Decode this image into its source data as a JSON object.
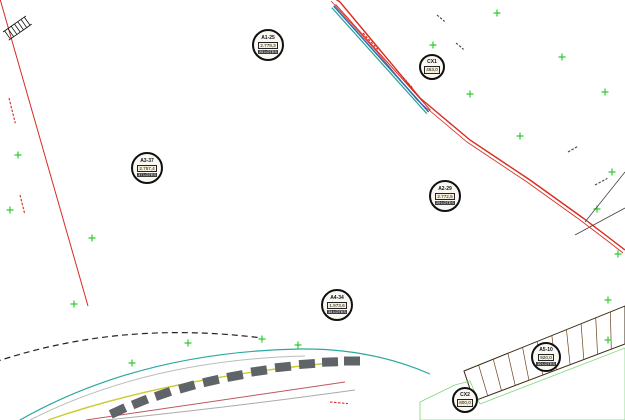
{
  "plan": {
    "size": {
      "w": 625,
      "h": 420
    },
    "colors": {
      "background": "#ffffff",
      "lot_fill": "#f2a45a",
      "lot_hatch": "#d4873a",
      "strip_line": "#4a3014",
      "division_line": "#6b421c",
      "block_outline": "#3a2a12",
      "road": "#44608c",
      "road_edge": "#d92b20",
      "boundary": "#d92b20",
      "avenue_stripe_blue": "#2a6db5",
      "avenue_stripe_teal": "#29a59b",
      "green_cross": "#2ecc2e",
      "green_line": "#3ecf3e",
      "green_area_fill": "#eef8ee",
      "green_area_line": "#7cd67c",
      "stall": "#5f6468",
      "arc_teal": "#2aa9a0",
      "arc_yellow": "#cccc2e",
      "arc_red": "#c05560",
      "dashed_boundary": "#222222",
      "badge_bg": "#faf8f2",
      "badge_border": "#101010",
      "badge_band": "#3f3f3f"
    },
    "labels": [
      {
        "key": "A1",
        "id": "A1-25",
        "area": "2.779,3",
        "lots": "25 LOTES",
        "x": 268,
        "y": 45,
        "r": 16,
        "type": "block"
      },
      {
        "key": "CX1",
        "id": "CX1",
        "area": "463,0",
        "lots": "",
        "x": 432,
        "y": 67,
        "r": 13,
        "type": "utility"
      },
      {
        "key": "A3",
        "id": "A3-37",
        "area": "2.757,4",
        "lots": "37 LOTES",
        "x": 147,
        "y": 168,
        "r": 16,
        "type": "block"
      },
      {
        "key": "A2",
        "id": "A2-29",
        "area": "2.772,5",
        "lots": "29 LOTES",
        "x": 445,
        "y": 196,
        "r": 16,
        "type": "block"
      },
      {
        "key": "A4",
        "id": "A4-34",
        "area": "1.973,6",
        "lots": "34 LOTES",
        "x": 337,
        "y": 305,
        "r": 16,
        "type": "block"
      },
      {
        "key": "A5",
        "id": "A5-10",
        "area": "920,0",
        "lots": "10 LOTES",
        "x": 546,
        "y": 357,
        "r": 15,
        "type": "block"
      },
      {
        "key": "CX2",
        "id": "CX2",
        "area": "800,0",
        "lots": "",
        "x": 465,
        "y": 400,
        "r": 13,
        "type": "utility"
      }
    ],
    "block_lot_counts": {
      "topleft": 13,
      "A3": 37,
      "c1rc": 16,
      "A1": 25,
      "c2rb": 22,
      "A4": 34,
      "c3ra": 12,
      "A2": 29,
      "c3rc": 18,
      "c4": 6,
      "c4rc": 4,
      "A5": 10
    },
    "crosses": [
      [
        18,
        155
      ],
      [
        10,
        210
      ],
      [
        92,
        238
      ],
      [
        74,
        304
      ],
      [
        132,
        363
      ],
      [
        188,
        343
      ],
      [
        262,
        339
      ],
      [
        298,
        345
      ],
      [
        433,
        45
      ],
      [
        497,
        13
      ],
      [
        470,
        94
      ],
      [
        520,
        136
      ],
      [
        562,
        57
      ],
      [
        605,
        92
      ],
      [
        612,
        172
      ],
      [
        597,
        209
      ],
      [
        618,
        254
      ],
      [
        608,
        300
      ],
      [
        608,
        340
      ]
    ]
  }
}
